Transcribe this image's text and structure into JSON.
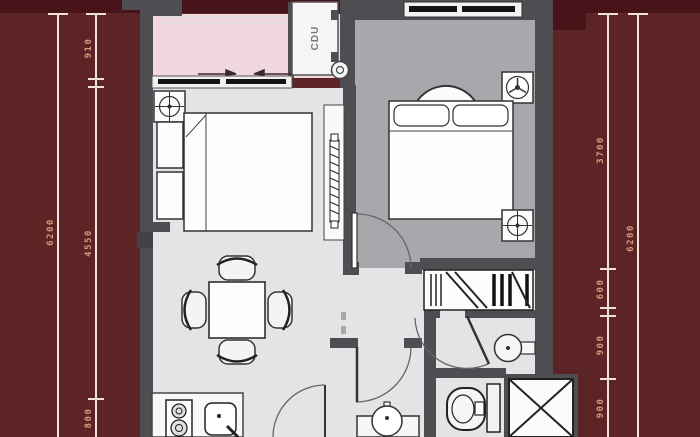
{
  "colors": {
    "background": "#5c2424",
    "background_dark_band": "#471419",
    "wall": "#4e4e52",
    "floor_light": "#e4e4e6",
    "floor_bedroom_right": "#a8a8ac",
    "balcony_pink": "#f0d8de",
    "furniture_white": "#fbfbfb",
    "dimension_line": "#f3e0d8",
    "dimension_text": "#d7997e"
  },
  "dimensions": {
    "left_outer": {
      "total": "6200"
    },
    "left_inner": {
      "segments": [
        "910",
        "4550",
        "800"
      ]
    },
    "right_inner": {
      "segments": [
        "3700",
        "600",
        "900",
        "900"
      ]
    },
    "right_outer": {
      "total": "6200"
    }
  },
  "plan": {
    "cdu_label": "CDU",
    "icons": [
      "ceiling-light-crosshair",
      "fan",
      "bed",
      "nightstand",
      "tv-panel",
      "armchair",
      "wardrobe-hangers",
      "washbasin",
      "toilet",
      "shaft-x",
      "dining-table",
      "chair",
      "stove",
      "kitchen-sink",
      "pedestal-sink",
      "door-swing",
      "sliding-door-arrows",
      "drain-pipe"
    ]
  }
}
